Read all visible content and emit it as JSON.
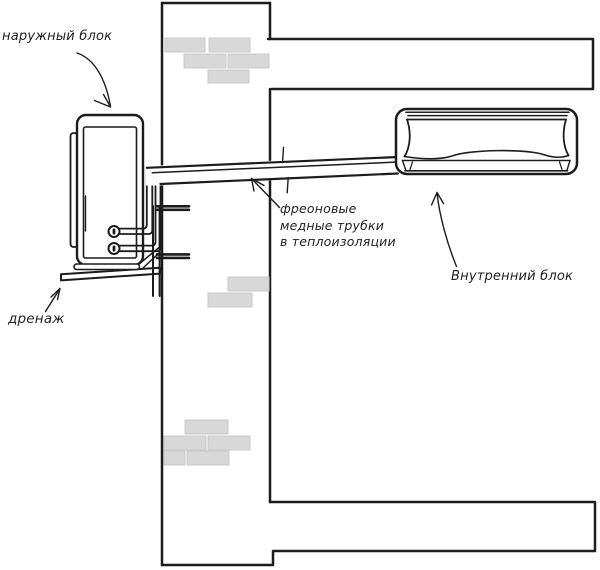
{
  "labels": {
    "outdoor_unit": "наружный блок",
    "freon_pipes": "фреоновые\nмедные трубки\nв теплоизоляции",
    "indoor_unit": "Внутренний блок",
    "drain": "дренаж"
  },
  "colors": {
    "line": "#1c1c1c",
    "brick": "#d8d8d8",
    "background": "#ffffff"
  }
}
